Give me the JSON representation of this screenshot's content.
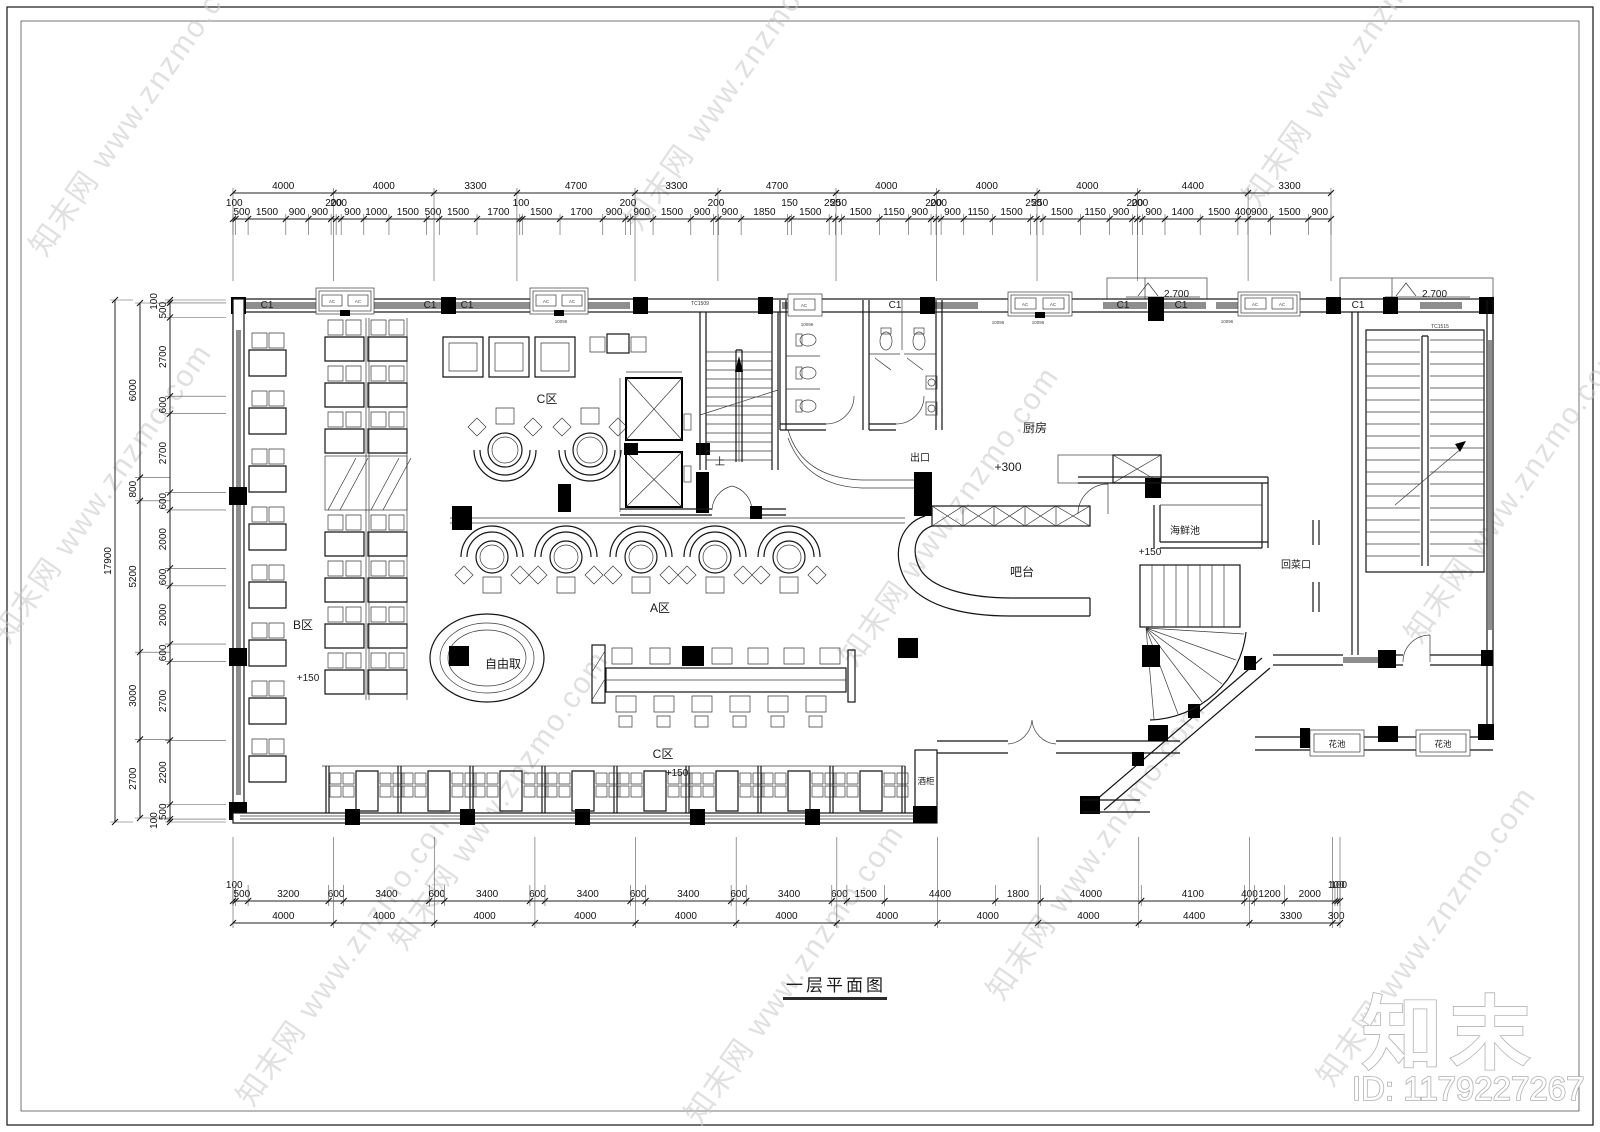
{
  "meta": {
    "title": "一层平面图",
    "watermark": "知末网 www.znzmo.com",
    "logo": "知末",
    "id_text": "ID: 1179227267"
  },
  "labels": {
    "c1": "C1",
    "tc1509": "TC1509",
    "tc1515": "TC1515",
    "code": "10096",
    "ac": "AC",
    "level_2700": "2.700",
    "zone_c": "C区",
    "zone_b": "B区",
    "zone_a": "A区",
    "buffet": "自由取",
    "kitchen": "厨房",
    "exit": "出口",
    "level_300": "+300",
    "seafood": "海鲜池",
    "level_150": "+150",
    "bar": "吧台",
    "dish_return": "回菜口",
    "wine_cabinet": "酒柜",
    "flower_bed": "花池",
    "up": "上"
  },
  "dimensions": {
    "top_outer": [
      "4000",
      "4000",
      "3300",
      "4700",
      "3300",
      "4700",
      "4000",
      "4000",
      "4000",
      "4400",
      "3300"
    ],
    "top_inner": [
      "100",
      "500",
      "1500",
      "900",
      "900",
      "200",
      "200",
      "900",
      "1000",
      "1500",
      "500",
      "1500",
      "1700",
      "100",
      "1500",
      "1700",
      "900",
      "200",
      "900",
      "1500",
      "900",
      "200",
      "900",
      "1850",
      "150",
      "1500",
      "250",
      "250",
      "1500",
      "1150",
      "900",
      "200",
      "200",
      "900",
      "1150",
      "1500",
      "250",
      "250",
      "1500",
      "1150",
      "900",
      "200",
      "200",
      "900",
      "1400",
      "1500",
      "400",
      "900",
      "1500",
      "900"
    ],
    "bottom_inner": [
      "100",
      "500",
      "3200",
      "600",
      "3400",
      "600",
      "3400",
      "600",
      "3400",
      "600",
      "3400",
      "600",
      "3400",
      "600",
      "1500",
      "4400",
      "1800",
      "4000",
      "4100",
      "400",
      "1200",
      "2000",
      "100",
      "100"
    ],
    "bottom_outer": [
      "4000",
      "4000",
      "4000",
      "4000",
      "4000",
      "4000",
      "4000",
      "4000",
      "4000",
      "4400",
      "3300",
      "300"
    ],
    "left_outer": [
      "17900"
    ],
    "left_mid": [
      "6000",
      "800",
      "5200",
      "3000",
      "2700"
    ],
    "left_inner": [
      "100",
      "500",
      "2700",
      "600",
      "2700",
      "600",
      "2000",
      "600",
      "2000",
      "600",
      "2700",
      "2200",
      "500",
      "100"
    ]
  }
}
